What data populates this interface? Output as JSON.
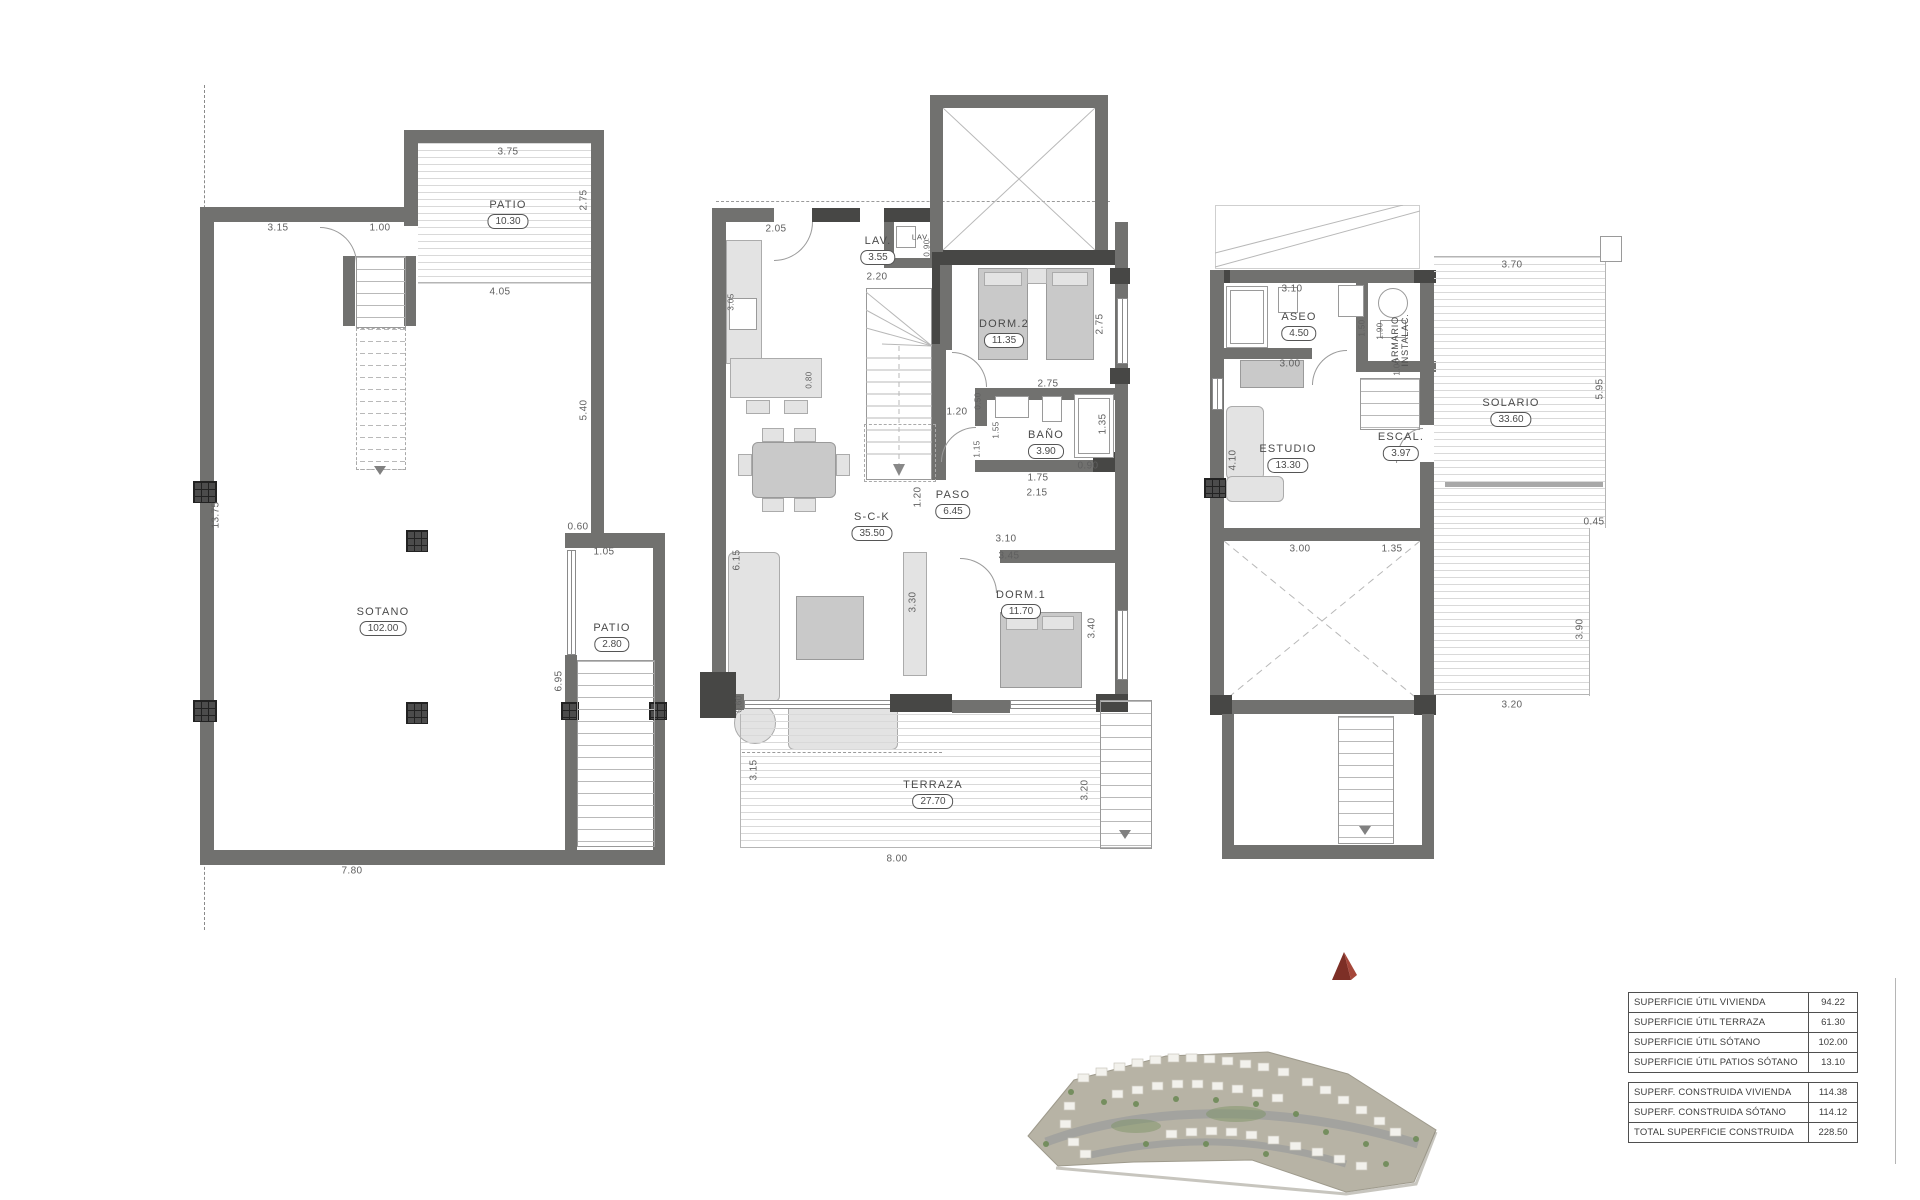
{
  "plans": {
    "sot": {
      "rooms": {
        "patio_top": {
          "name": "PATIO",
          "value": "10.30"
        },
        "main": {
          "name": "SOTANO",
          "value": "102.00"
        },
        "patio_side": {
          "name": "PATIO",
          "value": "2.80"
        }
      },
      "dims": {
        "d375": "3.75",
        "d275": "2.75",
        "d315": "3.15",
        "d100": "1.00",
        "d405": "4.05",
        "d540": "5.40",
        "d1375": "13.75",
        "d060": "0.60",
        "d105": "1.05",
        "d695": "6.95",
        "d780": "7.80"
      }
    },
    "pb": {
      "rooms": {
        "lav": {
          "name": "LAV.",
          "value": "3.55"
        },
        "lav_small": {
          "name": "LAV."
        },
        "dorm2": {
          "name": "DORM.2",
          "value": "11.35"
        },
        "bano": {
          "name": "BAÑO",
          "value": "3.90"
        },
        "paso": {
          "name": "PASO",
          "value": "6.45"
        },
        "sck": {
          "name": "S-C-K",
          "value": "35.50"
        },
        "dorm1": {
          "name": "DORM.1",
          "value": "11.70"
        },
        "terraza": {
          "name": "TERRAZA",
          "value": "27.70"
        }
      },
      "dims": {
        "d205": "2.05",
        "d220": "2.20",
        "d090s": "0.90",
        "d305": "3.05",
        "d080": "0.80",
        "d275v": "2.75",
        "d275h": "2.75",
        "d050": "0.50",
        "d155": "1.55",
        "d115": "1.15",
        "d120h": "1.20",
        "d135": "1.35",
        "d090": "0.90",
        "d175": "1.75",
        "d215": "2.15",
        "d120v": "1.20",
        "d310": "3.10",
        "d345": "3.45",
        "d330": "3.30",
        "d340": "3.40",
        "d615": "6.15",
        "d060": "0.60",
        "d315": "3.15",
        "d320": "3.20",
        "d800": "8.00"
      }
    },
    "pa": {
      "rooms": {
        "aseo": {
          "name": "ASEO",
          "value": "4.50"
        },
        "armario": {
          "name": "ARMARIO",
          "name2": "INSTALAC."
        },
        "estudio": {
          "name": "ESTUDIO",
          "value": "13.30"
        },
        "escal": {
          "name": "ESCAL.",
          "value": "3.97"
        },
        "solario": {
          "name": "SOLARIO",
          "value": "33.60"
        }
      },
      "dims": {
        "d310": "3.10",
        "d150": "1.50",
        "d190": "1.90",
        "d100": "1.00",
        "d300a": "3.00",
        "d410": "4.10",
        "d300b": "3.00",
        "d135": "1.35",
        "d370": "3.70",
        "d595": "5.95",
        "d045": "0.45",
        "d390": "3.90",
        "d320": "3.20"
      }
    }
  },
  "table": {
    "groups": [
      {
        "rows": [
          {
            "label": "SUPERFICIE ÚTIL VIVIENDA",
            "value": "94.22"
          },
          {
            "label": "SUPERFICIE ÚTIL TERRAZA",
            "value": "61.30"
          },
          {
            "label": "SUPERFICIE ÚTIL SÓTANO",
            "value": "102.00"
          },
          {
            "label": "SUPERFICIE ÚTIL PATIOS SÓTANO",
            "value": "13.10"
          }
        ]
      },
      {
        "rows": [
          {
            "label": "SUPERF. CONSTRUIDA VIVIENDA",
            "value": "114.38"
          },
          {
            "label": "SUPERF. CONSTRUIDA SÓTANO",
            "value": "114.12"
          },
          {
            "label": "TOTAL SUPERFICIE CONSTRUIDA",
            "value": "228.50"
          }
        ]
      }
    ]
  }
}
